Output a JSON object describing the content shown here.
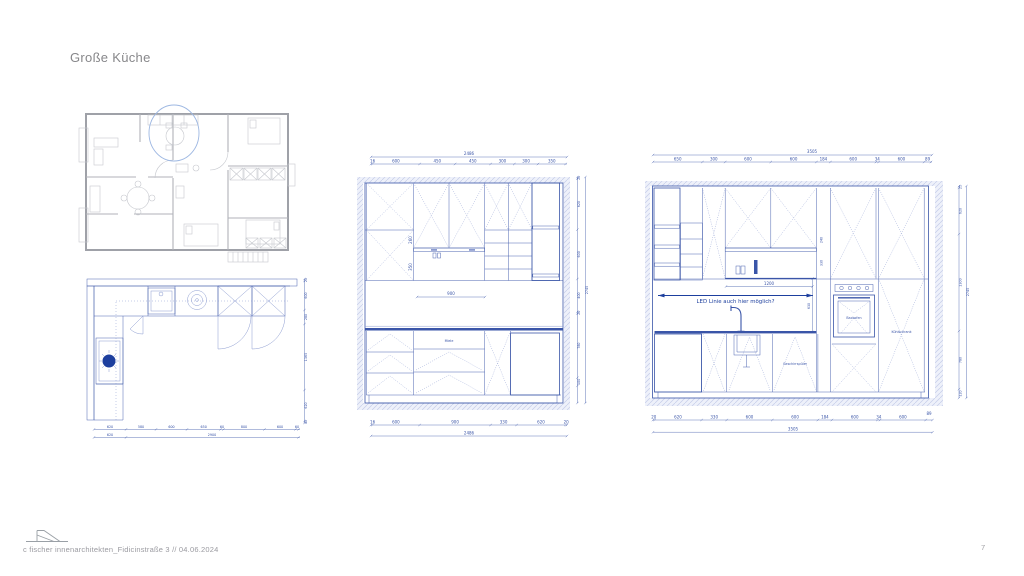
{
  "page": {
    "title": "Große Küche",
    "footer_text": "c fischer innenarchitekten_Fidicinstraße 3 // 04.06.2024",
    "page_number": "7"
  },
  "colors": {
    "drawing_blue": "#3a55a8",
    "annotation_blue": "#1d3f9e",
    "hatch_fill": "#dde4f5",
    "wall_fill": "#eef1fa",
    "plan_gray": "#b0b2b9",
    "highlight_ellipse": "#9db7e2",
    "text_gray": "#87878a"
  },
  "floor_plan": {
    "dims_bottom_row1": [
      "620",
      "580",
      "600",
      "650",
      "60",
      "800",
      "600",
      "60"
    ],
    "dims_bottom_row2": [
      "620",
      "2900"
    ],
    "dims_right": [
      "20",
      "600",
      "280",
      "1365",
      "620",
      "40"
    ]
  },
  "elevation_mid": {
    "top_total": "2486",
    "top_dims": [
      "16",
      "600",
      "450",
      "450",
      "300",
      "300",
      "350"
    ],
    "niche_dim_upper": "260",
    "niche_dim_lower": "350",
    "niche_width": "900",
    "unit_label": "Miele",
    "right_dims": [
      "20",
      "620",
      "600",
      "400",
      "20",
      "780",
      "100"
    ],
    "right_total": "2745",
    "bottom_dims": [
      "16",
      "600",
      "900",
      "330",
      "620",
      "20"
    ],
    "bottom_total": "2486"
  },
  "elevation_right": {
    "top_total": "3505",
    "top_dims": [
      "650",
      "300",
      "600",
      "600",
      "184",
      "600",
      "34",
      "600",
      "89"
    ],
    "annotation": "LED Linie auch hier möglich?",
    "led_dim": "1200",
    "niche_height_dim": "630",
    "shelf_dim_upper": "240",
    "shelf_dim_lower": "330",
    "label_oven": "Backofen",
    "label_fridge": "Kühlschrank",
    "label_dishwasher": "Geschirrspüler",
    "right_dims": [
      "25",
      "620",
      "1300",
      "780",
      "120"
    ],
    "right_total": "2745",
    "bottom_dims": [
      "20",
      "620",
      "330",
      "600",
      "600",
      "184",
      "600",
      "34",
      "600"
    ],
    "bottom_corner": "89",
    "bottom_total": "3505"
  }
}
